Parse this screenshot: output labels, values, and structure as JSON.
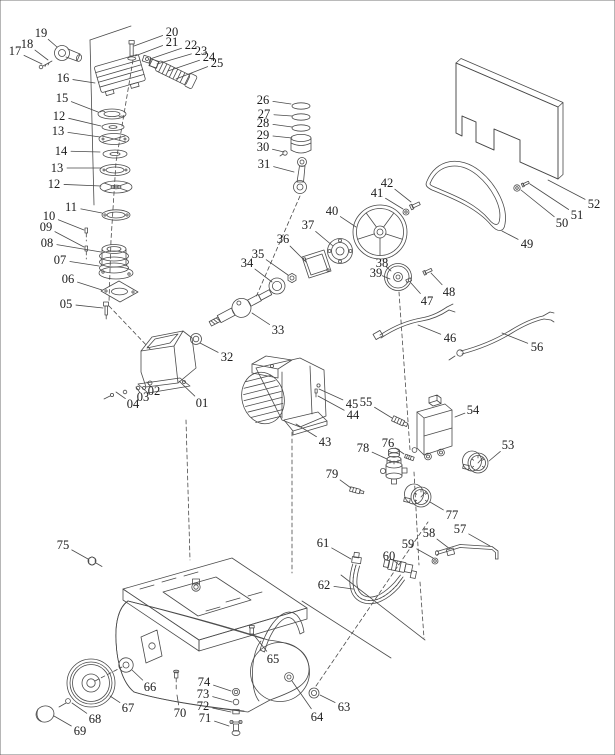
{
  "diagram": {
    "type": "exploded-parts-diagram",
    "subject": "air compressor spare parts",
    "style": {
      "background": "#ffffff",
      "line_color": "#4a4a4a",
      "leader_color": "#6a6a6a",
      "label_color": "#1c1c1c"
    },
    "labels": [
      {
        "text": "17",
        "x": 15,
        "y": 51,
        "tx": 42,
        "ty": 64
      },
      {
        "text": "18",
        "x": 27,
        "y": 44,
        "tx": 48,
        "ty": 60
      },
      {
        "text": "19",
        "x": 41,
        "y": 33,
        "tx": 57,
        "ty": 47
      },
      {
        "text": "16",
        "x": 63,
        "y": 78,
        "tx": 95,
        "ty": 83
      },
      {
        "text": "15",
        "x": 62,
        "y": 98,
        "tx": 98,
        "ty": 112
      },
      {
        "text": "12",
        "x": 59,
        "y": 116,
        "tx": 101,
        "ty": 126
      },
      {
        "text": "13",
        "x": 58,
        "y": 131,
        "tx": 100,
        "ty": 137
      },
      {
        "text": "14",
        "x": 61,
        "y": 151,
        "tx": 100,
        "ty": 152
      },
      {
        "text": "13",
        "x": 57,
        "y": 168,
        "tx": 102,
        "ty": 168
      },
      {
        "text": "12",
        "x": 54,
        "y": 184,
        "tx": 101,
        "ty": 186
      },
      {
        "text": "11",
        "x": 71,
        "y": 207,
        "tx": 102,
        "ty": 213
      },
      {
        "text": "10",
        "x": 49,
        "y": 216,
        "tx": 84,
        "ty": 230
      },
      {
        "text": "09",
        "x": 46,
        "y": 227,
        "tx": 84,
        "ty": 247
      },
      {
        "text": "08",
        "x": 47,
        "y": 243,
        "tx": 101,
        "ty": 252
      },
      {
        "text": "07",
        "x": 60,
        "y": 260,
        "tx": 99,
        "ty": 266
      },
      {
        "text": "06",
        "x": 68,
        "y": 279,
        "tx": 102,
        "ty": 290
      },
      {
        "text": "05",
        "x": 66,
        "y": 304,
        "tx": 103,
        "ty": 308
      },
      {
        "text": "20",
        "x": 172,
        "y": 32,
        "tx": 134,
        "ty": 46
      },
      {
        "text": "21",
        "x": 172,
        "y": 42,
        "tx": 135,
        "ty": 56
      },
      {
        "text": "22",
        "x": 191,
        "y": 45,
        "tx": 150,
        "ty": 59
      },
      {
        "text": "23",
        "x": 201,
        "y": 51,
        "tx": 157,
        "ty": 64
      },
      {
        "text": "24",
        "x": 209,
        "y": 57,
        "tx": 168,
        "ty": 71
      },
      {
        "text": "25",
        "x": 217,
        "y": 63,
        "tx": 176,
        "ty": 79
      },
      {
        "text": "26",
        "x": 263,
        "y": 100,
        "tx": 291,
        "ty": 104
      },
      {
        "text": "27",
        "x": 264,
        "y": 114,
        "tx": 292,
        "ty": 116
      },
      {
        "text": "28",
        "x": 263,
        "y": 123,
        "tx": 292,
        "ty": 127
      },
      {
        "text": "29",
        "x": 263,
        "y": 135,
        "tx": 292,
        "ty": 138
      },
      {
        "text": "30",
        "x": 263,
        "y": 147,
        "tx": 284,
        "ty": 152
      },
      {
        "text": "31",
        "x": 264,
        "y": 164,
        "tx": 294,
        "ty": 172
      },
      {
        "text": "32",
        "x": 227,
        "y": 357,
        "tx": 200,
        "ty": 343
      },
      {
        "text": "33",
        "x": 278,
        "y": 330,
        "tx": 252,
        "ty": 313
      },
      {
        "text": "34",
        "x": 247,
        "y": 263,
        "tx": 272,
        "ty": 282
      },
      {
        "text": "35",
        "x": 258,
        "y": 254,
        "tx": 288,
        "ty": 275
      },
      {
        "text": "36",
        "x": 283,
        "y": 239,
        "tx": 306,
        "ty": 262
      },
      {
        "text": "37",
        "x": 308,
        "y": 225,
        "tx": 333,
        "ty": 246
      },
      {
        "text": "38",
        "x": 382,
        "y": 263,
        "tx": 391,
        "ty": 271
      },
      {
        "text": "39",
        "x": 376,
        "y": 273,
        "tx": 390,
        "ty": 279
      },
      {
        "text": "40",
        "x": 332,
        "y": 211,
        "tx": 356,
        "ty": 227
      },
      {
        "text": "41",
        "x": 377,
        "y": 193,
        "tx": 403,
        "ty": 209
      },
      {
        "text": "42",
        "x": 387,
        "y": 183,
        "tx": 411,
        "ty": 202
      },
      {
        "text": "43",
        "x": 325,
        "y": 442,
        "tx": 296,
        "ty": 424
      },
      {
        "text": "44",
        "x": 353,
        "y": 415,
        "tx": 318,
        "ty": 396
      },
      {
        "text": "45",
        "x": 352,
        "y": 404,
        "tx": 319,
        "ty": 389
      },
      {
        "text": "55",
        "x": 366,
        "y": 402,
        "tx": 392,
        "ty": 418
      },
      {
        "text": "46",
        "x": 450,
        "y": 338,
        "tx": 418,
        "ty": 325
      },
      {
        "text": "47",
        "x": 427,
        "y": 301,
        "tx": 411,
        "ty": 283
      },
      {
        "text": "48",
        "x": 449,
        "y": 292,
        "tx": 431,
        "ty": 273
      },
      {
        "text": "49",
        "x": 527,
        "y": 244,
        "tx": 502,
        "ty": 231
      },
      {
        "text": "50",
        "x": 562,
        "y": 223,
        "tx": 521,
        "ty": 190
      },
      {
        "text": "51",
        "x": 577,
        "y": 215,
        "tx": 530,
        "ty": 184
      },
      {
        "text": "52",
        "x": 594,
        "y": 204,
        "tx": 548,
        "ty": 180
      },
      {
        "text": "53",
        "x": 508,
        "y": 445,
        "tx": 489,
        "ty": 461
      },
      {
        "text": "54",
        "x": 473,
        "y": 410,
        "tx": 455,
        "ty": 417
      },
      {
        "text": "56",
        "x": 537,
        "y": 347,
        "tx": 502,
        "ty": 333
      },
      {
        "text": "57",
        "x": 460,
        "y": 529,
        "tx": 490,
        "ty": 546
      },
      {
        "text": "58",
        "x": 429,
        "y": 533,
        "tx": 450,
        "ty": 549
      },
      {
        "text": "59",
        "x": 408,
        "y": 544,
        "tx": 433,
        "ty": 558
      },
      {
        "text": "60",
        "x": 389,
        "y": 556,
        "tx": 399,
        "ty": 565
      },
      {
        "text": "61",
        "x": 323,
        "y": 543,
        "tx": 351,
        "ty": 559
      },
      {
        "text": "62",
        "x": 324,
        "y": 585,
        "tx": 353,
        "ty": 589
      },
      {
        "text": "63",
        "x": 344,
        "y": 707,
        "tx": 320,
        "ty": 695
      },
      {
        "text": "64",
        "x": 317,
        "y": 717,
        "tx": 292,
        "ty": 681
      },
      {
        "text": "65",
        "x": 273,
        "y": 659,
        "tx": 253,
        "ty": 634
      },
      {
        "text": "66",
        "x": 150,
        "y": 687,
        "tx": 132,
        "ty": 670
      },
      {
        "text": "67",
        "x": 128,
        "y": 708,
        "tx": 110,
        "ty": 696
      },
      {
        "text": "68",
        "x": 95,
        "y": 719,
        "tx": 72,
        "ty": 703
      },
      {
        "text": "69",
        "x": 80,
        "y": 731,
        "tx": 54,
        "ty": 716
      },
      {
        "text": "70",
        "x": 180,
        "y": 713,
        "tx": 177,
        "ty": 695
      },
      {
        "text": "71",
        "x": 205,
        "y": 718,
        "tx": 229,
        "ty": 726
      },
      {
        "text": "72",
        "x": 203,
        "y": 706,
        "tx": 231,
        "ty": 712
      },
      {
        "text": "73",
        "x": 203,
        "y": 694,
        "tx": 232,
        "ty": 702
      },
      {
        "text": "74",
        "x": 204,
        "y": 682,
        "tx": 231,
        "ty": 691
      },
      {
        "text": "75",
        "x": 63,
        "y": 545,
        "tx": 88,
        "ty": 559
      },
      {
        "text": "76",
        "x": 388,
        "y": 443,
        "tx": 404,
        "ty": 454
      },
      {
        "text": "77",
        "x": 452,
        "y": 515,
        "tx": 430,
        "ty": 502
      },
      {
        "text": "78",
        "x": 363,
        "y": 448,
        "tx": 387,
        "ty": 459
      },
      {
        "text": "79",
        "x": 332,
        "y": 474,
        "tx": 351,
        "ty": 488
      },
      {
        "text": "01",
        "x": 202,
        "y": 403,
        "tx": 179,
        "ty": 381
      },
      {
        "text": "02",
        "x": 154,
        "y": 391,
        "tx": 147,
        "ty": 382
      },
      {
        "text": "03",
        "x": 143,
        "y": 397,
        "tx": 136,
        "ty": 387
      },
      {
        "text": "04",
        "x": 133,
        "y": 404,
        "tx": 116,
        "ty": 392
      }
    ]
  }
}
